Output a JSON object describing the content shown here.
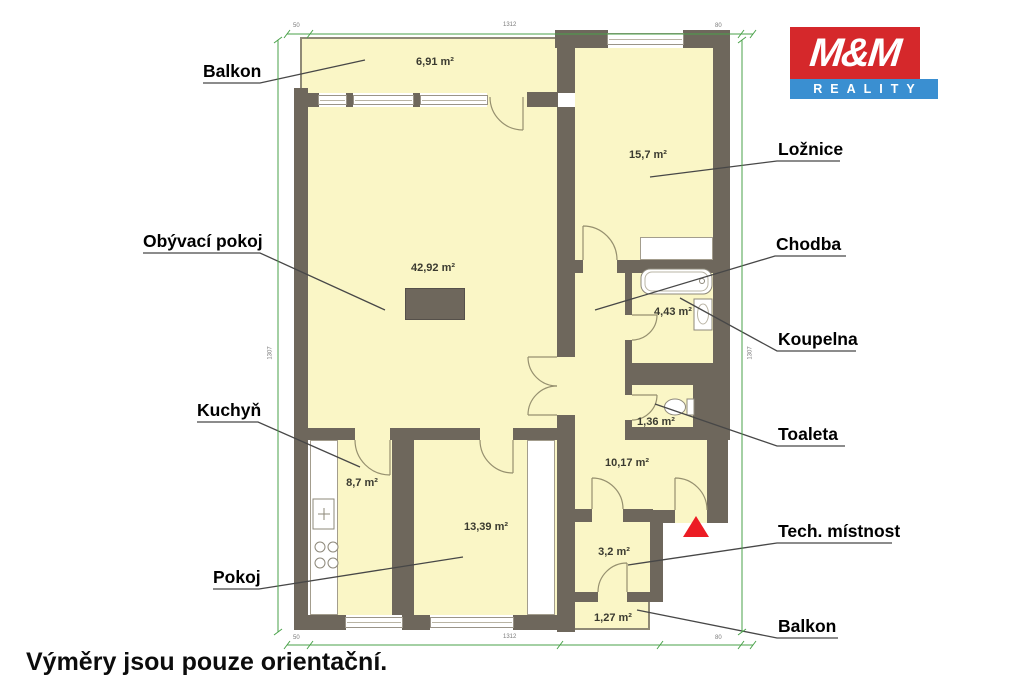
{
  "logo": {
    "top": "M&M",
    "bottom": "REALITY",
    "red": "#d5282b",
    "blue": "#3a8fd1"
  },
  "disclaimer": "Výměry jsou pouze orientační.",
  "rooms": {
    "balkon_top": {
      "label": "Balkon",
      "area": "6,91 m²"
    },
    "obyvaci_pokoj": {
      "label": "Obývací pokoj",
      "area": "42,92 m²"
    },
    "loznice": {
      "label": "Ložnice",
      "area": "15,7 m²"
    },
    "chodba": {
      "label": "Chodba",
      "area": "10,17 m²"
    },
    "koupelna": {
      "label": "Koupelna",
      "area": "4,43 m²"
    },
    "toaleta": {
      "label": "Toaleta",
      "area": "1,36 m²"
    },
    "kuchyn": {
      "label": "Kuchyň",
      "area": "8,7 m²"
    },
    "pokoj": {
      "label": "Pokoj",
      "area": "13,39 m²"
    },
    "tech_mistnost": {
      "label": "Tech. místnost",
      "area": "3,2 m²"
    },
    "balkon_bottom": {
      "label": "Balkon",
      "area": "1,27 m²"
    }
  },
  "dims": {
    "top": [
      "50",
      "1312",
      "80"
    ],
    "bottom": [
      "50",
      "1312",
      "80"
    ],
    "left": "1307",
    "right": "1307"
  },
  "colors": {
    "wall": "#6e675c",
    "floor": "#faf6c6",
    "dimension_line": "#4aa24a",
    "entrance_marker": "#ec1c24"
  }
}
